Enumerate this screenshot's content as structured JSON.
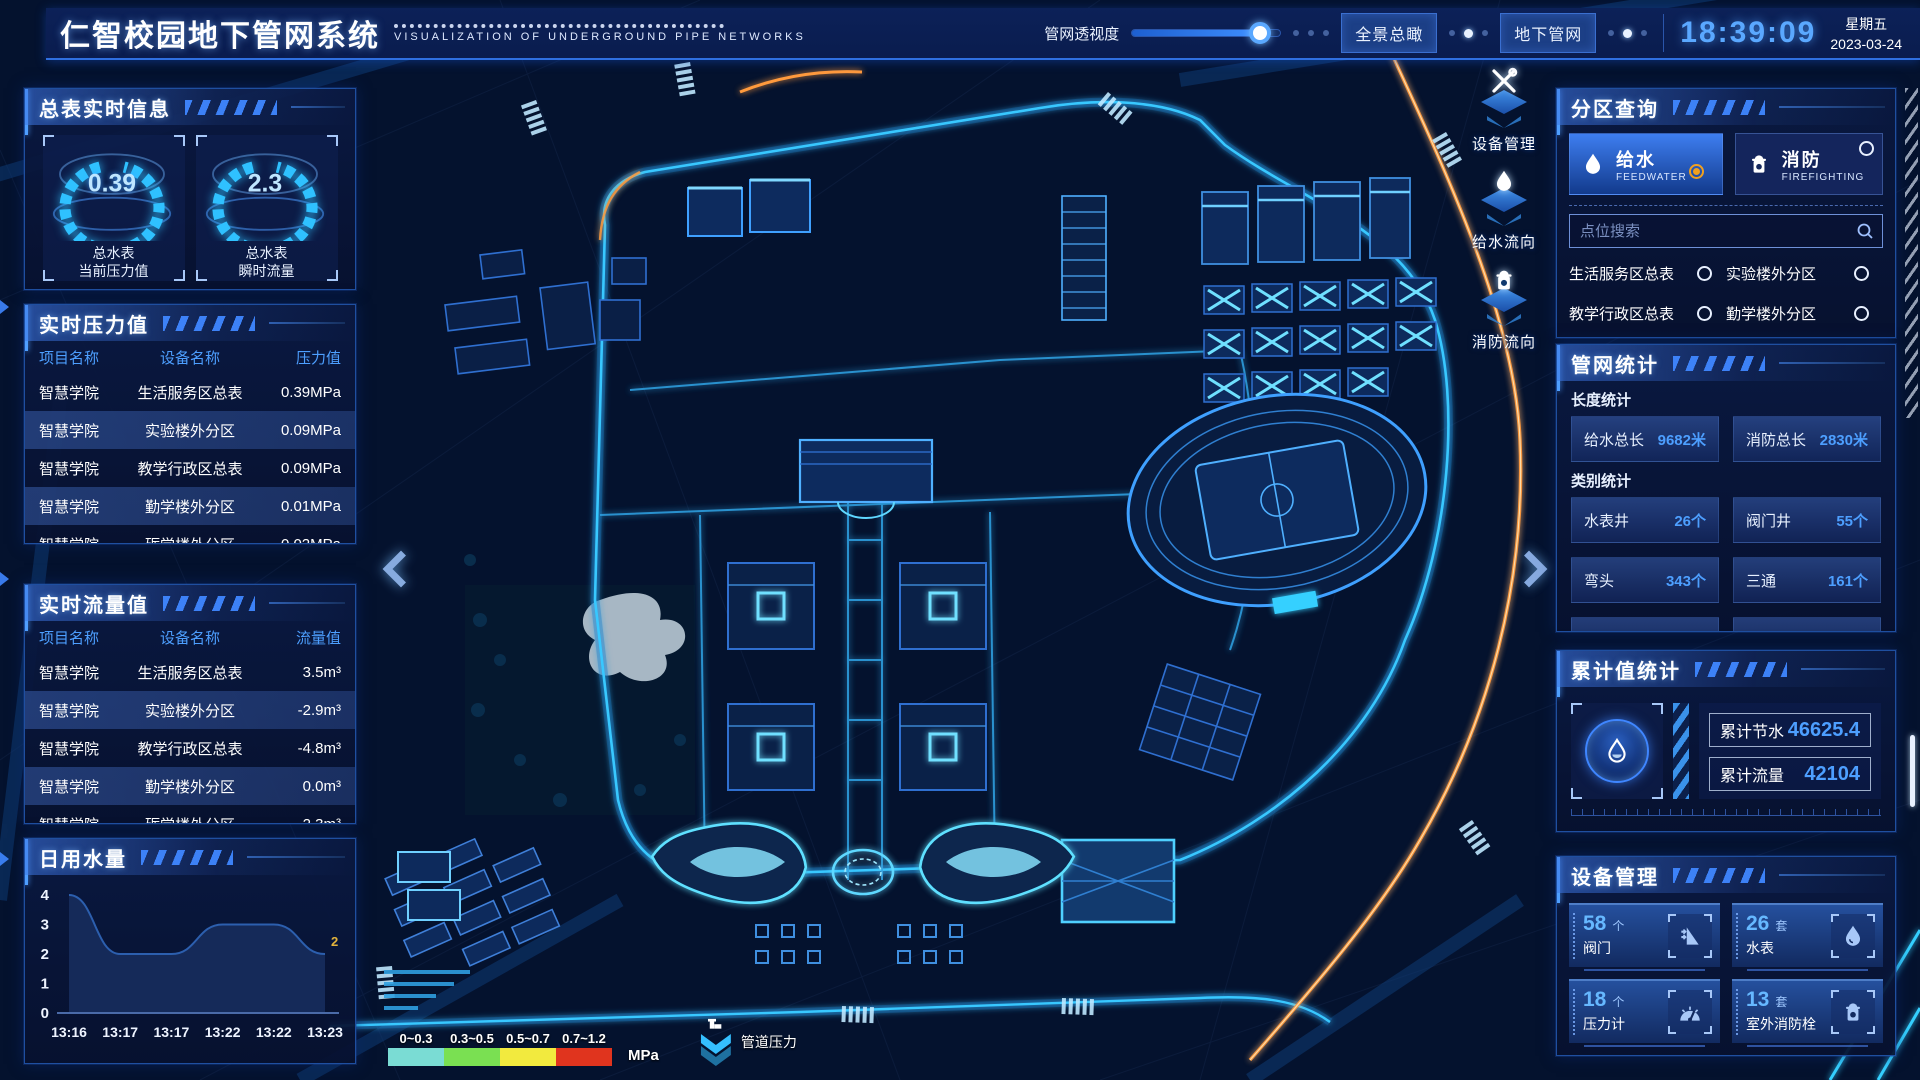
{
  "theme": {
    "accent": "#4d9fff",
    "glow_cyan": "#35d0ff",
    "panel_bg": "#0a1942",
    "header_bg": "#0b2057",
    "alert_orange": "#f0a020"
  },
  "header": {
    "title": "仁智校园地下管网系统",
    "subtitle": "VISUALIZATION OF UNDERGROUND PIPE NETWORKS",
    "slider_label": "管网透视度",
    "slider_percent": 86,
    "btn_overview": "全景总瞰",
    "btn_underground": "地下管网",
    "clock": "18:39:09",
    "weekday": "星期五",
    "date": "2023-03-24"
  },
  "left": {
    "realtime_info": {
      "title": "总表实时信息",
      "gauges": [
        {
          "value": "0.39",
          "line1": "总水表",
          "line2": "当前压力值"
        },
        {
          "value": "2.3",
          "line1": "总水表",
          "line2": "瞬时流量"
        }
      ]
    },
    "pressure": {
      "title": "实时压力值",
      "headers": [
        "项目名称",
        "设备名称",
        "压力值"
      ],
      "rows": [
        [
          "智慧学院",
          "生活服务区总表",
          "0.39MPa"
        ],
        [
          "智慧学院",
          "实验楼外分区",
          "0.09MPa"
        ],
        [
          "智慧学院",
          "教学行政区总表",
          "0.09MPa"
        ],
        [
          "智慧学院",
          "勤学楼外分区",
          "0.01MPa"
        ],
        [
          "智慧学院",
          "砺学楼外分区",
          "0.02MPa"
        ]
      ]
    },
    "flow": {
      "title": "实时流量值",
      "headers": [
        "项目名称",
        "设备名称",
        "流量值"
      ],
      "rows": [
        [
          "智慧学院",
          "生活服务区总表",
          "3.5m³"
        ],
        [
          "智慧学院",
          "实验楼外分区",
          "-2.9m³"
        ],
        [
          "智慧学院",
          "教学行政区总表",
          "-4.8m³"
        ],
        [
          "智慧学院",
          "勤学楼外分区",
          "0.0m³"
        ],
        [
          "智慧学院",
          "砺学楼外分区",
          "2.3m³"
        ]
      ]
    },
    "daily_water": {
      "title": "日用水量",
      "chart": {
        "type": "area",
        "x": [
          "13:16",
          "13:17",
          "13:17",
          "13:22",
          "13:22",
          "13:23"
        ],
        "values": [
          4,
          2,
          2,
          3,
          3,
          2
        ],
        "y_ticks": [
          0,
          1,
          2,
          3,
          4
        ],
        "ylim": [
          0,
          4
        ],
        "last_point_label": "2",
        "last_label_color": "#e2b33c"
      }
    }
  },
  "map": {
    "overlay_badges": [
      {
        "icon": "tools-icon",
        "label": "设备管理"
      },
      {
        "icon": "water-drop-icon",
        "label": "给水流向"
      },
      {
        "icon": "hydrant-icon",
        "label": "消防流向"
      }
    ],
    "legend": {
      "ranges": [
        "0~0.3",
        "0.3~0.5",
        "0.5~0.7",
        "0.7~1.2"
      ],
      "colors": [
        "#7adcd4",
        "#7ae052",
        "#f2ea3e",
        "#e0341e"
      ],
      "unit": "MPa",
      "label": "管道压力"
    }
  },
  "right": {
    "zone_query": {
      "title": "分区查询",
      "tabs": [
        {
          "label": "给水",
          "sub": "FEEDWATER",
          "icon": "water-drop-icon",
          "selected": true
        },
        {
          "label": "消防",
          "sub": "FIREFIGHTING",
          "icon": "hydrant-icon",
          "selected": false
        }
      ],
      "search_placeholder": "点位搜索",
      "items": [
        "生活服务区总表",
        "实验楼外分区",
        "教学行政区总表",
        "勤学楼外分区",
        "砺学楼外分区",
        "宿舍区泵房"
      ]
    },
    "pipe_stats": {
      "title": "管网统计",
      "length_title": "长度统计",
      "length_stats": [
        {
          "label": "给水总长",
          "value": "9682米"
        },
        {
          "label": "消防总长",
          "value": "2830米"
        }
      ],
      "category_title": "类别统计",
      "category_stats": [
        {
          "label": "水表井",
          "value": "26个"
        },
        {
          "label": "阀门井",
          "value": "55个"
        },
        {
          "label": "弯头",
          "value": "343个"
        },
        {
          "label": "三通",
          "value": "161个"
        }
      ]
    },
    "cumulative": {
      "title": "累计值统计",
      "items": [
        {
          "label": "累计节水",
          "value": "46625.4"
        },
        {
          "label": "累计流量",
          "value": "42104"
        }
      ]
    },
    "devices": {
      "title": "设备管理",
      "cards": [
        {
          "count": "58",
          "unit": "个",
          "label": "阀门",
          "icon": "valve-icon"
        },
        {
          "count": "26",
          "unit": "套",
          "label": "水表",
          "icon": "water-meter-icon"
        },
        {
          "count": "18",
          "unit": "个",
          "label": "压力计",
          "icon": "pressure-gauge-icon"
        },
        {
          "count": "13",
          "unit": "套",
          "label": "室外消防栓",
          "icon": "hydrant-icon"
        }
      ]
    }
  }
}
